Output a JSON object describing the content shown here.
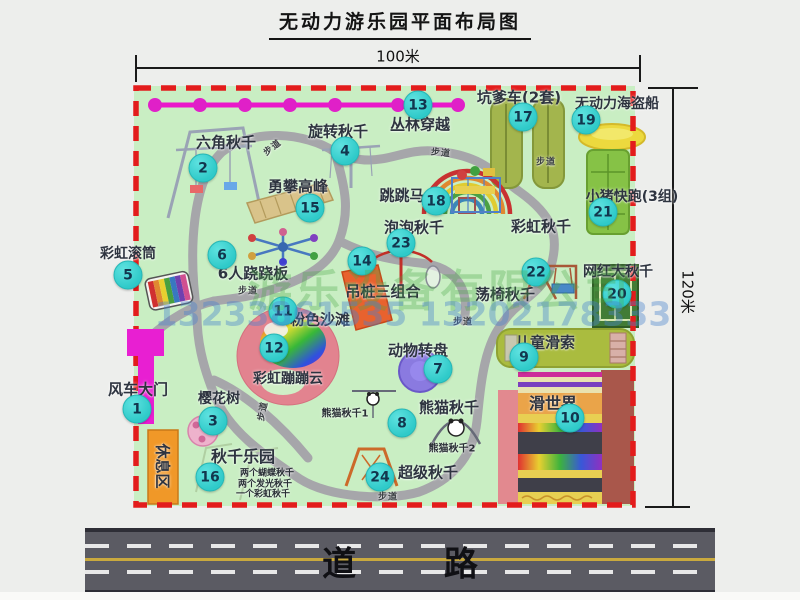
{
  "title": "无动力游乐园平面布局图",
  "dimensions": {
    "top": "100米",
    "right": "120米"
  },
  "road_label": "道 路",
  "watermark": {
    "company": "游乐设备有限公司",
    "phones": "13233861535 13202178333"
  },
  "map": {
    "markers": [
      {
        "n": "1",
        "x": 137,
        "y": 409
      },
      {
        "n": "2",
        "x": 203,
        "y": 168
      },
      {
        "n": "3",
        "x": 213,
        "y": 421
      },
      {
        "n": "4",
        "x": 345,
        "y": 151
      },
      {
        "n": "5",
        "x": 128,
        "y": 275
      },
      {
        "n": "6",
        "x": 222,
        "y": 255
      },
      {
        "n": "7",
        "x": 438,
        "y": 369
      },
      {
        "n": "8",
        "x": 402,
        "y": 423
      },
      {
        "n": "9",
        "x": 524,
        "y": 357
      },
      {
        "n": "10",
        "x": 570,
        "y": 418
      },
      {
        "n": "11",
        "x": 283,
        "y": 311
      },
      {
        "n": "12",
        "x": 274,
        "y": 348
      },
      {
        "n": "13",
        "x": 418,
        "y": 105
      },
      {
        "n": "14",
        "x": 362,
        "y": 261
      },
      {
        "n": "15",
        "x": 310,
        "y": 208
      },
      {
        "n": "16",
        "x": 210,
        "y": 477
      },
      {
        "n": "17",
        "x": 523,
        "y": 117
      },
      {
        "n": "18",
        "x": 436,
        "y": 201
      },
      {
        "n": "19",
        "x": 586,
        "y": 120
      },
      {
        "n": "20",
        "x": 617,
        "y": 294
      },
      {
        "n": "21",
        "x": 603,
        "y": 212
      },
      {
        "n": "22",
        "x": 536,
        "y": 272
      },
      {
        "n": "23",
        "x": 401,
        "y": 243
      },
      {
        "n": "24",
        "x": 380,
        "y": 477
      }
    ],
    "labels": [
      {
        "t": "六角秋千",
        "x": 226,
        "y": 142,
        "fs": 15
      },
      {
        "t": "旋转秋千",
        "x": 338,
        "y": 131,
        "fs": 15
      },
      {
        "t": "丛林穿越",
        "x": 420,
        "y": 124,
        "fs": 15
      },
      {
        "t": "坑爹车(2套)",
        "x": 519,
        "y": 97,
        "fs": 15
      },
      {
        "t": "无动力海盗船",
        "x": 617,
        "y": 103,
        "fs": 14
      },
      {
        "t": "勇攀高峰",
        "x": 298,
        "y": 186,
        "fs": 15
      },
      {
        "t": "跳跳马",
        "x": 402,
        "y": 195,
        "fs": 15
      },
      {
        "t": "泡泡秋千",
        "x": 414,
        "y": 227,
        "fs": 15
      },
      {
        "t": "彩虹秋千",
        "x": 541,
        "y": 226,
        "fs": 15
      },
      {
        "t": "小猪快跑(3组)",
        "x": 632,
        "y": 196,
        "fs": 14
      },
      {
        "t": "彩虹滚筒",
        "x": 128,
        "y": 253,
        "fs": 14
      },
      {
        "t": "6人跷跷板",
        "x": 253,
        "y": 273,
        "fs": 15
      },
      {
        "t": "吊桩三组合",
        "x": 383,
        "y": 291,
        "fs": 15
      },
      {
        "t": "荡椅秋千",
        "x": 505,
        "y": 294,
        "fs": 15
      },
      {
        "t": "网红大秋千",
        "x": 618,
        "y": 271,
        "fs": 14
      },
      {
        "t": "粉色沙滩",
        "x": 320,
        "y": 319,
        "fs": 15
      },
      {
        "t": "彩虹蹦蹦云",
        "x": 288,
        "y": 378,
        "fs": 14
      },
      {
        "t": "动物转盘",
        "x": 418,
        "y": 350,
        "fs": 15
      },
      {
        "t": "儿童滑索",
        "x": 545,
        "y": 342,
        "fs": 15
      },
      {
        "t": "滑世界",
        "x": 553,
        "y": 402,
        "fs": 16
      },
      {
        "t": "风车大门",
        "x": 138,
        "y": 389,
        "fs": 15
      },
      {
        "t": "樱花树",
        "x": 219,
        "y": 398,
        "fs": 14
      },
      {
        "t": "秋千乐园",
        "x": 243,
        "y": 455,
        "fs": 16
      },
      {
        "t": "两个蝴蝶秋千",
        "x": 267,
        "y": 472,
        "fs": 9,
        "cls": "note"
      },
      {
        "t": "两个发光秋千",
        "x": 265,
        "y": 483,
        "fs": 9,
        "cls": "note"
      },
      {
        "t": "一个彩虹秋千",
        "x": 263,
        "y": 493,
        "fs": 9,
        "cls": "note"
      },
      {
        "t": "熊猫秋千1",
        "x": 345,
        "y": 412,
        "fs": 10,
        "cls": "note"
      },
      {
        "t": "熊猫秋千",
        "x": 449,
        "y": 407,
        "fs": 15
      },
      {
        "t": "熊猫秋千2",
        "x": 452,
        "y": 447,
        "fs": 10,
        "cls": "note"
      },
      {
        "t": "超级秋千",
        "x": 428,
        "y": 472,
        "fs": 15
      },
      {
        "t": "休息区",
        "x": 163,
        "y": 466,
        "fs": 15,
        "rot": 90
      },
      {
        "t": "步道",
        "x": 272,
        "y": 147,
        "fs": 9,
        "rot": -38,
        "cls": "path"
      },
      {
        "t": "步道",
        "x": 441,
        "y": 152,
        "fs": 9,
        "rot": 6,
        "cls": "path"
      },
      {
        "t": "步道",
        "x": 546,
        "y": 161,
        "fs": 9,
        "cls": "path"
      },
      {
        "t": "步道",
        "x": 248,
        "y": 290,
        "fs": 9,
        "cls": "path"
      },
      {
        "t": "步道",
        "x": 463,
        "y": 321,
        "fs": 9,
        "cls": "path"
      },
      {
        "t": "步道",
        "x": 262,
        "y": 411,
        "fs": 9,
        "rot": -78,
        "cls": "path"
      },
      {
        "t": "步道",
        "x": 388,
        "y": 496,
        "fs": 9,
        "cls": "path"
      }
    ]
  }
}
